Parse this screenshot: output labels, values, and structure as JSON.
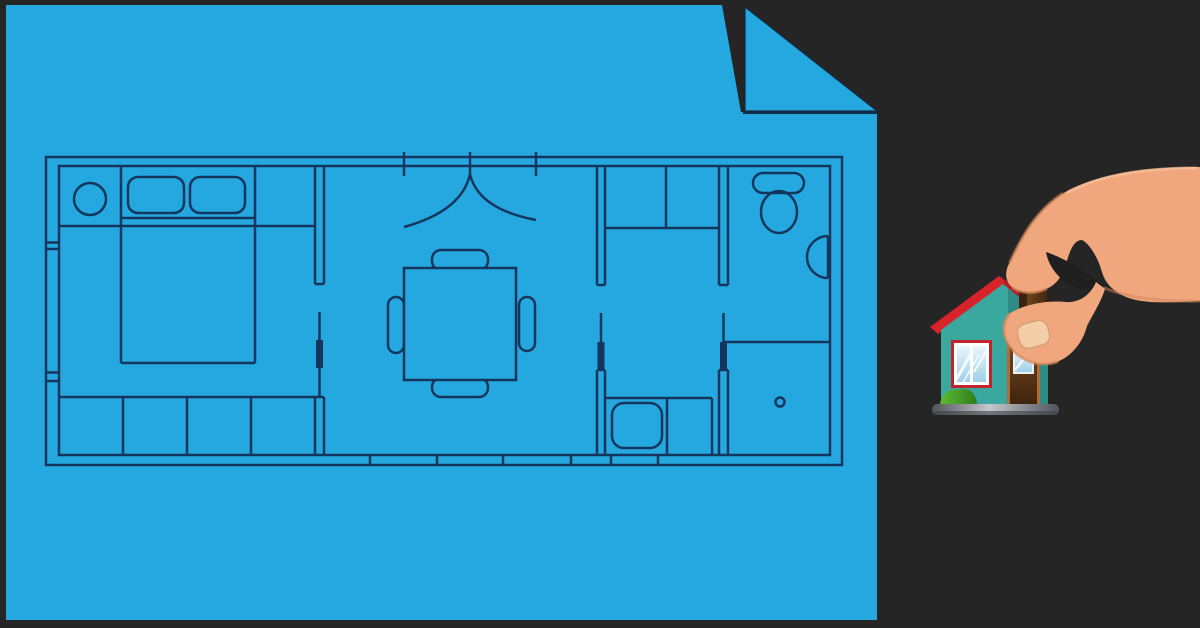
{
  "scene": {
    "background_color": "#252525",
    "blueprint": {
      "paper_color": "#25A8E0",
      "line_color": "#14365C",
      "label": "house-floor-plan-blueprint",
      "elements": [
        "outer-walls",
        "bed",
        "pillows",
        "bedside-table",
        "wardrobe",
        "sliding-doors",
        "entry-double-door",
        "dining-table",
        "dining-chairs",
        "kitchen-closet",
        "kitchen-sink",
        "counter",
        "toilet",
        "wall-sink",
        "shower",
        "window-marks"
      ]
    },
    "house": {
      "roof_color": "#D8232A",
      "roof_side_color": "#B81D23",
      "wall_color": "#3BA8A0",
      "wall_side_color": "#2E8B85",
      "window_frame_color": "#C2242B",
      "window_glass_color": "#D6EDF8",
      "door_frame_color": "#A86F3D",
      "door_color": "#6B441F",
      "door_window_color": "#C9E9F8",
      "chimney_color": "#5C3819",
      "bush_color": "#4DAE2E",
      "base_color": "#9FA3AA"
    },
    "hand": {
      "skin_color": "#F0A77E",
      "shade_color": "#D28457",
      "highlight_color": "#F8C6A3",
      "nail_color": "#F4CEA9",
      "crease_color": "#1F1F1F"
    }
  }
}
